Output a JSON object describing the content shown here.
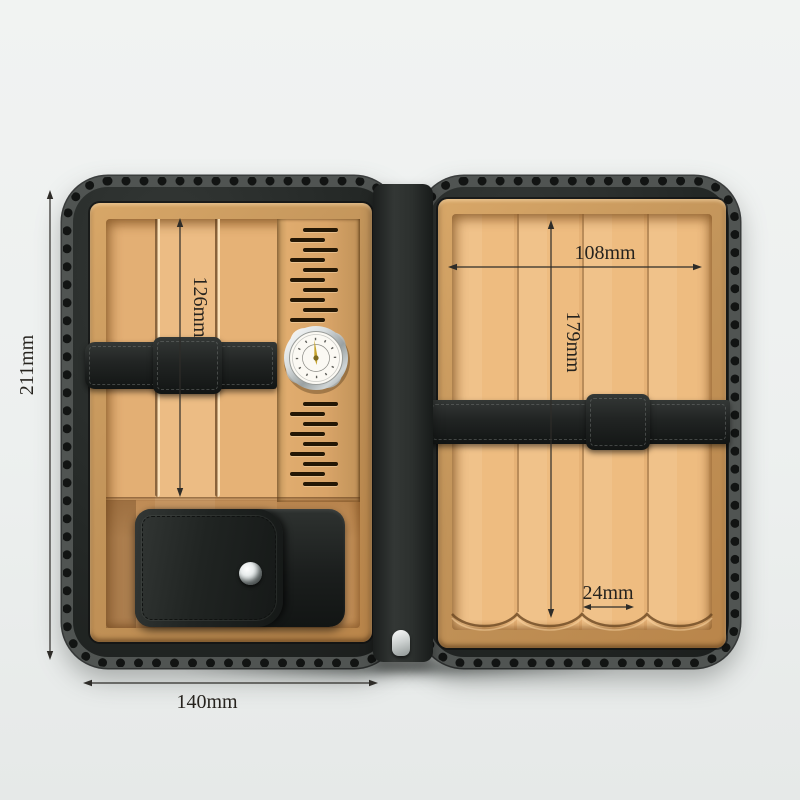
{
  "dimensions": {
    "overall_height": "211mm",
    "left_panel_height": "126mm",
    "overall_width": "140mm",
    "right_panel_width": "108mm",
    "right_panel_height": "179mm",
    "cigar_slot_width": "24mm"
  },
  "colors": {
    "background": "#eef0ef",
    "leather_black": "#242826",
    "wood_light": "#eebd84",
    "wood_mid": "#d9a468",
    "annotation_ink": "#26231e",
    "needle_gold": "#c7a42e",
    "silver": "#d6dadb"
  },
  "icons": {
    "hygrometer": "hygrometer-gauge",
    "snap_button": "snap-fastener",
    "zipper_pull": "zipper-pull",
    "vent_slots": "ventilation-slots"
  }
}
